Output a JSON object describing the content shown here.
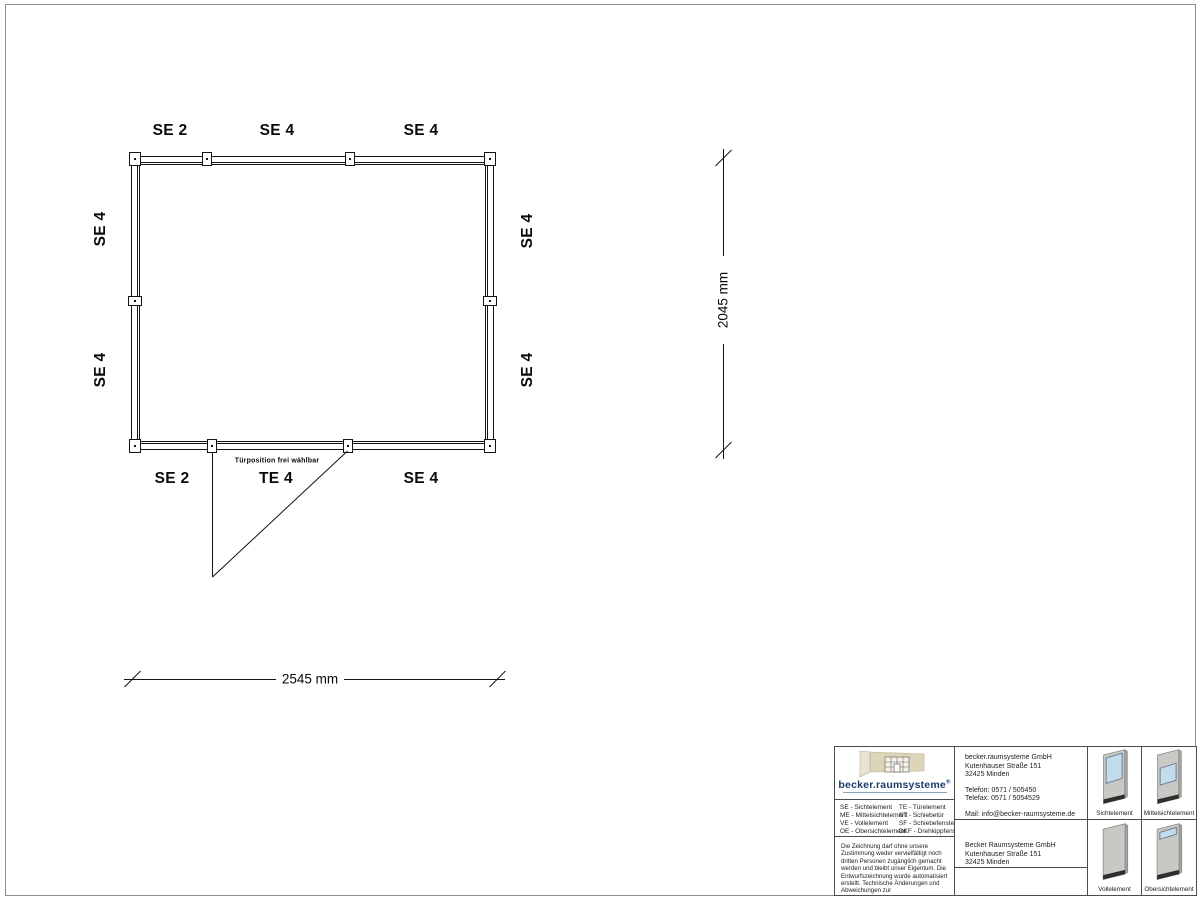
{
  "plan": {
    "top_labels": [
      "SE 2",
      "SE 4",
      "SE 4"
    ],
    "bottom_labels": [
      "SE 2",
      "TE 4",
      "SE 4"
    ],
    "left_labels": [
      "SE 4",
      "SE 4"
    ],
    "right_labels": [
      "SE 4",
      "SE 4"
    ],
    "door_note": "Türposition frei wählbar",
    "width_dim": "2545 mm",
    "height_dim": "2045 mm"
  },
  "titleblock": {
    "logo": {
      "text": "becker.raumsysteme",
      "reg": "®"
    },
    "legend_left": [
      "SE - Sichtelement",
      "ME - Mittelsichtelement",
      "VE - Vollelement",
      "OE - Obersichtelement"
    ],
    "legend_right": [
      "TE - Türelement",
      "ST - Schiebetür",
      "SF - Schiebefenster",
      "DKF - Drehkippfenster"
    ],
    "disclaimer": "Die Zeichnung darf ohne unsere Zustimmung weder vervielfältigt noch dritten Personen zugänglich gemacht werden und bleibt unser Eigentum. Die Entwurfszeichnung wurde automatisiert erstellt. Technische Änderungen und Abweichungen zur Ausführungszeichnung behalten wir uns vor.",
    "contact": {
      "name": "becker.raumsysteme GmbH",
      "street": "Kutenhauser Straße 151",
      "city": "32425 Minden",
      "phone": "Telefon: 0571 / 505450",
      "fax": "Telefax: 0571 / 5054529",
      "mail": "Mail: info@becker-raumsysteme.de",
      "web": "Web: www.becker-raumsysteme.de"
    },
    "manufacturer": {
      "name": "Becker Raumsysteme GmbH",
      "street": "Kutenhauser Straße 151",
      "city": "32425 Minden"
    },
    "elements": [
      {
        "label": "Sichtelement"
      },
      {
        "label": "Mittelsichtelement"
      },
      {
        "label": "Vollelement"
      },
      {
        "label": "Obersichtelement"
      }
    ]
  },
  "colors": {
    "line": "#141414",
    "page_border": "#8f8f8f",
    "logo_blue": "#1d3a6b",
    "logo_beige": "#ddd5ba",
    "glass_blue": "#c3dcec",
    "panel_gray": "#c8c8c5",
    "base_dark": "#2e2e2c"
  }
}
